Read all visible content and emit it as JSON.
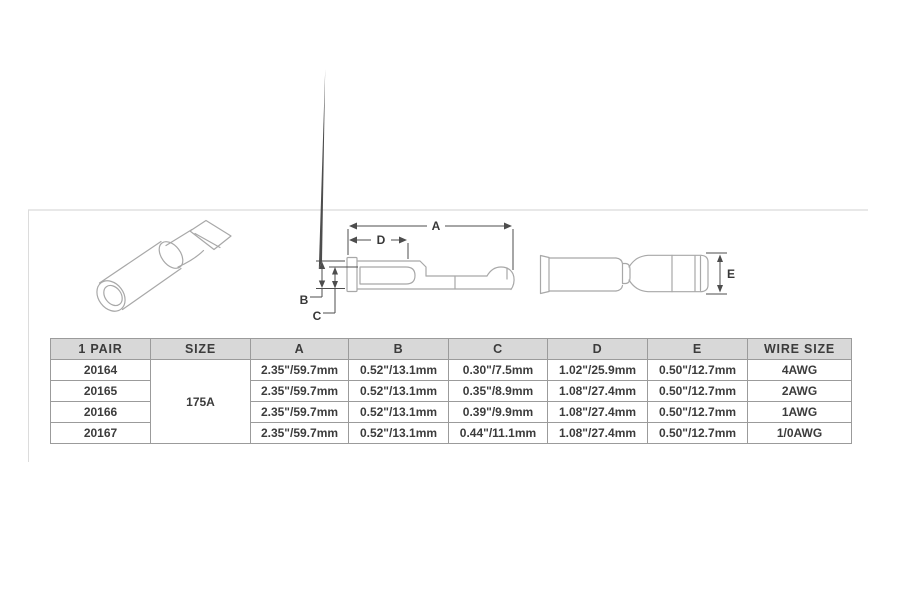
{
  "diagram": {
    "labels": {
      "a": "A",
      "b": "B",
      "c": "C",
      "d": "D",
      "e": "E"
    },
    "views": [
      "perspective-view",
      "side-view-with-dimensions",
      "top-view"
    ]
  },
  "table": {
    "headers": [
      "1 PAIR",
      "SIZE",
      "A",
      "B",
      "C",
      "D",
      "E",
      "WIRE SIZE"
    ],
    "size_shared": "175A",
    "rows": [
      {
        "pair": "20164",
        "a": "2.35\"/59.7mm",
        "b": "0.52\"/13.1mm",
        "c": "0.30\"/7.5mm",
        "d": "1.02\"/25.9mm",
        "e": "0.50\"/12.7mm",
        "wire": "4AWG"
      },
      {
        "pair": "20165",
        "a": "2.35\"/59.7mm",
        "b": "0.52\"/13.1mm",
        "c": "0.35\"/8.9mm",
        "d": "1.08\"/27.4mm",
        "e": "0.50\"/12.7mm",
        "wire": "2AWG"
      },
      {
        "pair": "20166",
        "a": "2.35\"/59.7mm",
        "b": "0.52\"/13.1mm",
        "c": "0.39\"/9.9mm",
        "d": "1.08\"/27.4mm",
        "e": "0.50\"/12.7mm",
        "wire": "1AWG"
      },
      {
        "pair": "20167",
        "a": "2.35\"/59.7mm",
        "b": "0.52\"/13.1mm",
        "c": "0.44\"/11.1mm",
        "d": "1.08\"/27.4mm",
        "e": "0.50\"/12.7mm",
        "wire": "1/0AWG"
      }
    ]
  },
  "colors": {
    "header_bg": "#d8d8d8",
    "table_border": "#9b9b9b",
    "table_outer_border": "#8b8b8b",
    "table_text": "#3c3c3c",
    "part_line": "#a8a8a8",
    "dim_line": "#4d4d4d",
    "label_color": "#383838",
    "frame_line": "#d2d2d2"
  }
}
